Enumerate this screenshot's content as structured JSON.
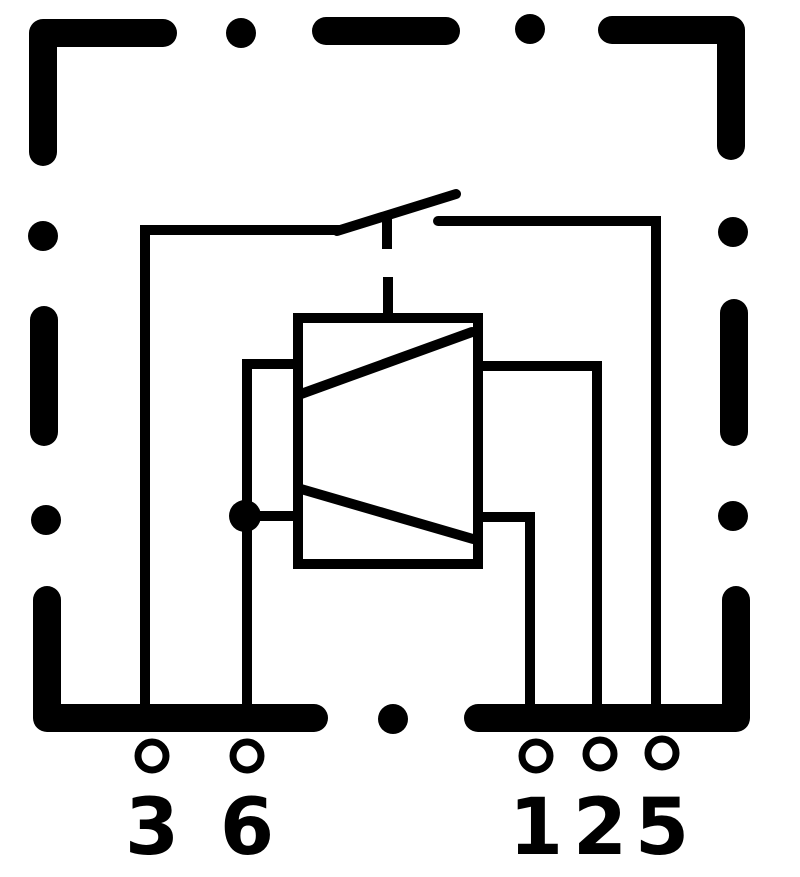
{
  "canvas": {
    "width": 800,
    "height": 877,
    "background": "#ffffff",
    "ink": "#000000"
  },
  "border": {
    "stroke_width": 28,
    "dot_radius": 15,
    "dashes": [
      {
        "name": "border-dash-top-left-corner",
        "points": [
          [
            163,
            33
          ],
          [
            43,
            33
          ],
          [
            43,
            152
          ]
        ]
      },
      {
        "name": "border-dash-top",
        "points": [
          [
            326,
            31
          ],
          [
            446,
            31
          ]
        ]
      },
      {
        "name": "border-dash-top-right-corner",
        "points": [
          [
            612,
            30
          ],
          [
            731,
            30
          ],
          [
            731,
            146
          ]
        ]
      },
      {
        "name": "border-dash-right",
        "points": [
          [
            734,
            313
          ],
          [
            734,
            432
          ]
        ]
      },
      {
        "name": "border-dash-bottom-right-corner",
        "points": [
          [
            736,
            600
          ],
          [
            736,
            718
          ],
          [
            478,
            718
          ]
        ]
      },
      {
        "name": "border-dash-bottom-left-corner",
        "points": [
          [
            47,
            600
          ],
          [
            47,
            718
          ],
          [
            314,
            718
          ]
        ]
      },
      {
        "name": "border-dash-left",
        "points": [
          [
            44,
            320
          ],
          [
            44,
            432
          ]
        ]
      }
    ],
    "dots": [
      {
        "name": "border-dot-top-1",
        "x": 241,
        "y": 33
      },
      {
        "name": "border-dot-top-2",
        "x": 530,
        "y": 29
      },
      {
        "name": "border-dot-right-1",
        "x": 733,
        "y": 232
      },
      {
        "name": "border-dot-right-2",
        "x": 733,
        "y": 516
      },
      {
        "name": "border-dot-bottom",
        "x": 393,
        "y": 719
      },
      {
        "name": "border-dot-left-1",
        "x": 43,
        "y": 236
      },
      {
        "name": "border-dot-left-2",
        "x": 46,
        "y": 520
      }
    ]
  },
  "circuit": {
    "stroke_width": 10,
    "wires": [
      {
        "name": "wire-terminal3-to-switch",
        "points": [
          [
            145,
            712
          ],
          [
            145,
            230
          ],
          [
            340,
            230
          ]
        ],
        "cap": "butt"
      },
      {
        "name": "switch-blade",
        "points": [
          [
            337,
            231
          ],
          [
            456,
            194
          ]
        ],
        "cap": "round"
      },
      {
        "name": "switch-blade-pivot-tick",
        "points": [
          [
            387,
            212
          ],
          [
            387,
            249
          ]
        ],
        "cap": "butt"
      },
      {
        "name": "wire-switch-to-terminal5",
        "points": [
          [
            438,
            221
          ],
          [
            656,
            221
          ],
          [
            656,
            712
          ]
        ],
        "cap": "round"
      },
      {
        "name": "switch-actuator-link",
        "points": [
          [
            388,
            277
          ],
          [
            388,
            318
          ]
        ],
        "cap": "butt"
      },
      {
        "name": "wire-coil-upper-left-to-terminal6",
        "points": [
          [
            299,
            364
          ],
          [
            247,
            364
          ],
          [
            247,
            712
          ]
        ],
        "cap": "butt"
      },
      {
        "name": "wire-coil-lower-left-to-junction",
        "points": [
          [
            299,
            516
          ],
          [
            247,
            516
          ]
        ],
        "cap": "butt"
      },
      {
        "name": "wire-coil-upper-right-to-terminal2",
        "points": [
          [
            477,
            366
          ],
          [
            597,
            366
          ],
          [
            597,
            712
          ]
        ],
        "cap": "butt"
      },
      {
        "name": "wire-coil-lower-right-to-terminal1",
        "points": [
          [
            477,
            517
          ],
          [
            530,
            517
          ],
          [
            530,
            712
          ]
        ],
        "cap": "butt"
      }
    ],
    "coil": {
      "box": {
        "x": 298,
        "y": 318,
        "width": 180,
        "height": 246
      },
      "diagonals": [
        {
          "name": "coil-winding-diagonal-upper",
          "points": [
            [
              472,
              332
            ],
            [
              301,
              394
            ]
          ]
        },
        {
          "name": "coil-winding-diagonal-lower",
          "points": [
            [
              301,
              489
            ],
            [
              473,
              539
            ]
          ]
        }
      ]
    },
    "junction": {
      "x": 245,
      "y": 516,
      "radius": 16
    }
  },
  "terminals": {
    "ring_radius": 14,
    "ring_stroke": 7,
    "label_font_size": 78,
    "items": [
      {
        "label": "3",
        "x": 152,
        "y": 756,
        "label_y": 854
      },
      {
        "label": "6",
        "x": 247,
        "y": 756,
        "label_y": 854
      },
      {
        "label": "1",
        "x": 536,
        "y": 756,
        "label_y": 854
      },
      {
        "label": "2",
        "x": 600,
        "y": 754,
        "label_y": 854
      },
      {
        "label": "5",
        "x": 662,
        "y": 753,
        "label_y": 854
      }
    ]
  }
}
